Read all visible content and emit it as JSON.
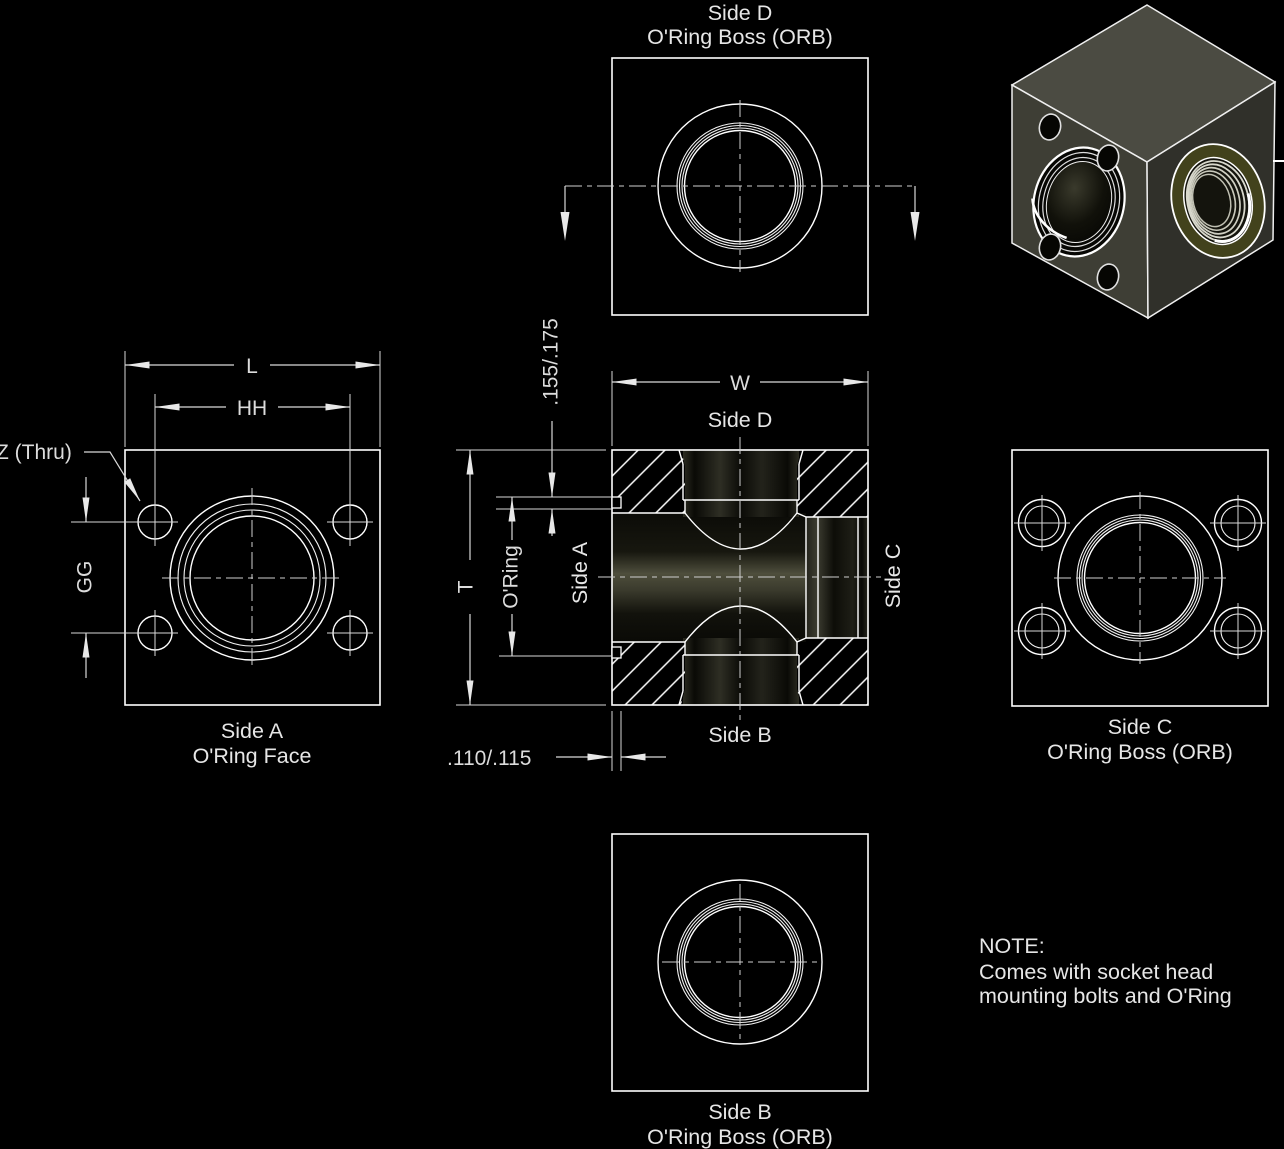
{
  "views": {
    "side_d_top": {
      "title": "Side D",
      "subtitle": "O'Ring Boss (ORB)"
    },
    "side_a": {
      "dim_l": "L",
      "dim_hh": "HH",
      "dim_gg": "GG",
      "label_z": "Z (Thru)",
      "caption": "Side A",
      "subcaption": "O'Ring Face"
    },
    "section": {
      "dim_w": "W",
      "dim_t": "T",
      "label_oring": "O'Ring",
      "dim_groove": ".155/.175",
      "dim_face": ".110/.115",
      "label_top": "Side D",
      "label_bottom": "Side B",
      "label_left": "Side A",
      "label_right": "Side C"
    },
    "side_c": {
      "caption": "Side C",
      "subcaption": "O'Ring Boss (ORB)"
    },
    "side_b": {
      "caption": "Side B",
      "subcaption": "O'Ring Boss (ORB)"
    }
  },
  "note": {
    "heading": "NOTE:",
    "line1": "Comes with socket head",
    "line2": "mounting bolts and O'Ring"
  },
  "colors": {
    "background": "#000000",
    "line": "#ffffff",
    "text": "#dcdcdc",
    "iso_top_face": "#4b4b42",
    "iso_left_face": "#3e3e35",
    "iso_right_face": "#30302a",
    "orb_ring_olive": "#42421c"
  }
}
